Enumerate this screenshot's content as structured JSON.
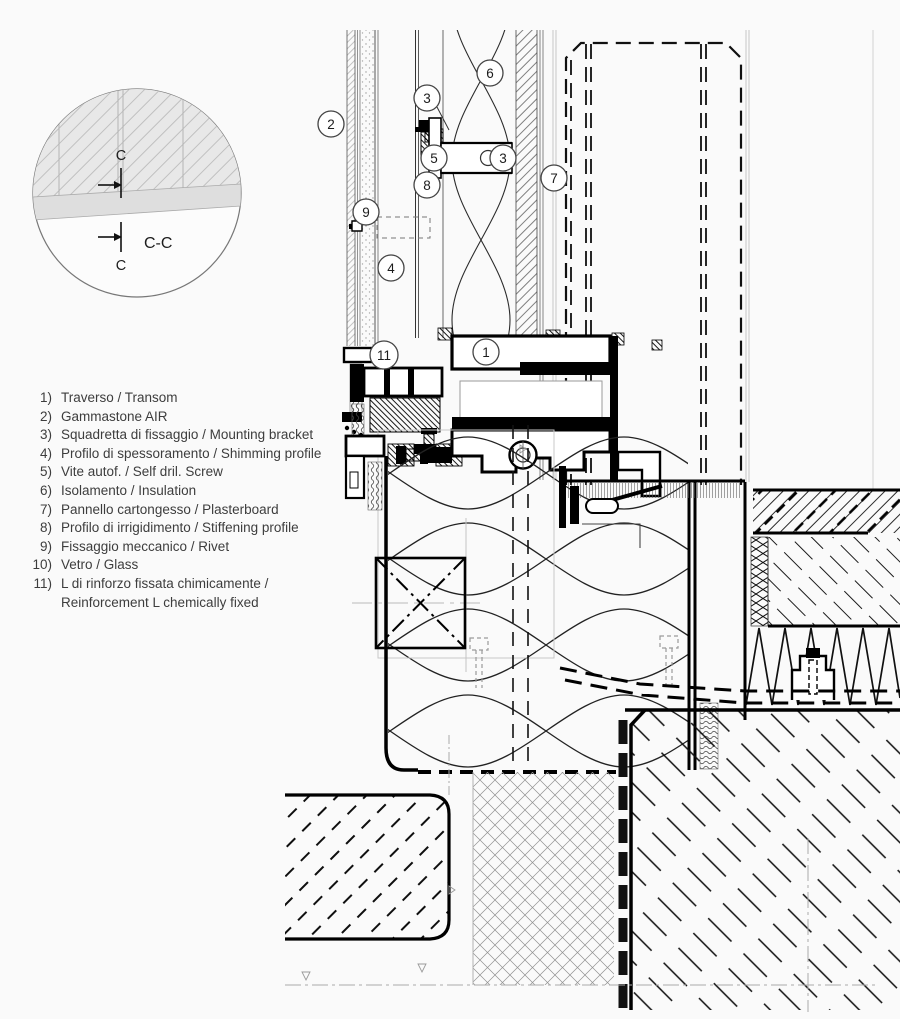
{
  "colors": {
    "paper": "#fafafa",
    "ink": "#141414",
    "light_line": "#9a9a9a",
    "detail_fill": "#fcfcfc",
    "wall_fill": "#e8e8e8",
    "band_fill": "#dedede"
  },
  "detail_view": {
    "top_mark": "C",
    "bottom_mark": "C",
    "section_label": "C-C"
  },
  "legend": {
    "items": [
      {
        "num": "1)",
        "label": "Traverso / Transom"
      },
      {
        "num": "2)",
        "label": "Gammastone AIR"
      },
      {
        "num": "3)",
        "label": "Squadretta di fissaggio / Mounting bracket"
      },
      {
        "num": "4)",
        "label": "Profilo di spessoramento / Shimming profile"
      },
      {
        "num": "5)",
        "label": "Vite autof. / Self dril. Screw"
      },
      {
        "num": "6)",
        "label": "Isolamento / Insulation"
      },
      {
        "num": "7)",
        "label": "Pannello cartongesso / Plasterboard"
      },
      {
        "num": "8)",
        "label": "Profilo di irrigidimento / Stiffening profile"
      },
      {
        "num": "9)",
        "label": "Fissaggio meccanico / Rivet"
      },
      {
        "num": "10)",
        "label": "Vetro / Glass"
      },
      {
        "num": "11)",
        "label": "L di rinforzo fissata chimicamente /",
        "label2": "Reinforcement L chemically fixed"
      }
    ]
  },
  "callouts": [
    {
      "label": "2"
    },
    {
      "label": "3"
    },
    {
      "label": "6"
    },
    {
      "label": "5"
    },
    {
      "label": "3"
    },
    {
      "label": "7"
    },
    {
      "label": "8"
    },
    {
      "label": "9"
    },
    {
      "label": "4"
    },
    {
      "label": "11"
    },
    {
      "label": "1"
    }
  ]
}
